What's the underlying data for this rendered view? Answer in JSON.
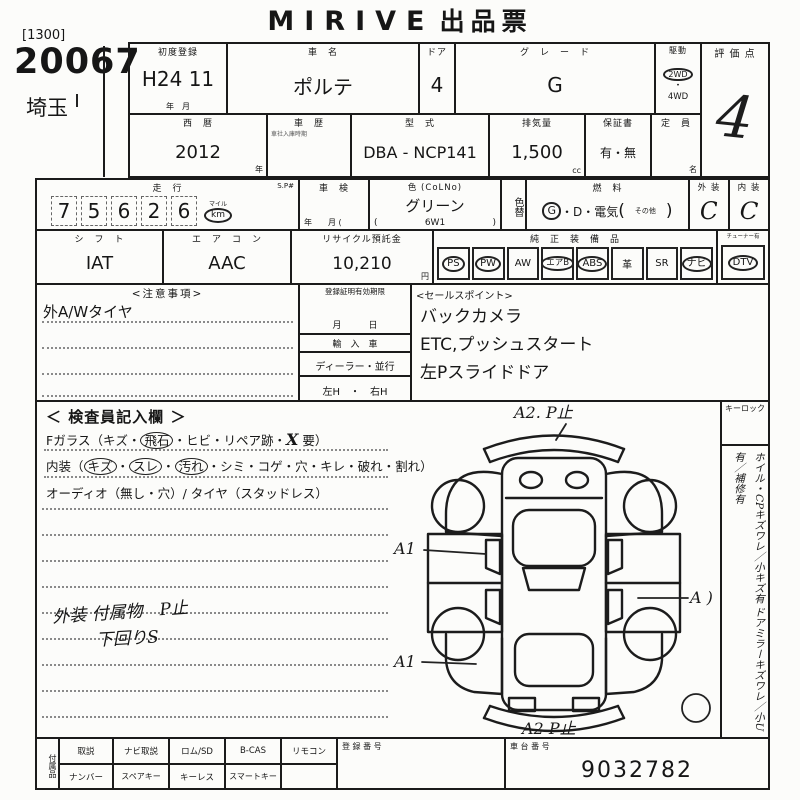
{
  "title": {
    "brand": "MIRIVE",
    "doc": "出品票"
  },
  "corner": {
    "code": "[1300]",
    "lot": "20067",
    "region": "埼玉"
  },
  "r1": {
    "first_reg_label": "初度登録",
    "first_reg": "H24 11",
    "first_reg_units": "年　月",
    "name_label": "車　名",
    "name": "ポルテ",
    "door_label": "ドア",
    "door": "4",
    "grade_label": "グ　レ　ー　ド",
    "grade": "G",
    "drive_label": "駆動",
    "drive1": "2WD",
    "drive_dot": "・",
    "drive2": "4WD",
    "score_label": "評 価 点",
    "score": "4"
  },
  "r2": {
    "year_label": "西　暦",
    "year": "2012",
    "year_unit": "年",
    "history_label": "車　歴",
    "history_note": "車社入庫時期",
    "model_label": "型　式",
    "model": "DBA - NCP141",
    "disp_label": "排気量",
    "disp": "1,500",
    "disp_unit": "cc",
    "warranty_label": "保証書",
    "warranty": "有・無",
    "cap_label": "定　員",
    "cap_unit": "名"
  },
  "r3": {
    "mileage_label": "走　行",
    "sp": "S.P#",
    "d0": "7",
    "d1": "5",
    "d2": "6",
    "d3": "2",
    "d4": "6",
    "mile": "マイル",
    "km": "km",
    "shaken_label": "車　検",
    "shaken_units": "年　　月 (",
    "color_label": "色 (CoLNo)",
    "color": "グリーン",
    "paren_l": "(",
    "color_code": "6W1",
    "paren_r": ")",
    "color_change": "色替",
    "fuel_label": "燃　料",
    "fuel_g": "G",
    "fuel_rest": "・D・電気",
    "fuel_paren_l": "(",
    "fuel_other": "その他",
    "fuel_paren_r": ")",
    "ext_label": "外 装",
    "ext": "C",
    "int_label": "内 装",
    "int": "C"
  },
  "r4": {
    "shift_label": "シ　フ　ト",
    "shift": "IAT",
    "ac_label": "エ　ア　コ　ン",
    "ac": "AAC",
    "recycle_label": "リサイクル預託金",
    "recycle": "10,210",
    "recycle_unit": "円",
    "equip_label": "純　正　装　備　品",
    "dtv_note": "チューナー有",
    "items": [
      {
        "label": "PS"
      },
      {
        "label": "PW"
      },
      {
        "label": "AW"
      },
      {
        "label": "エアB"
      },
      {
        "label": "ABS"
      },
      {
        "label": "革"
      },
      {
        "label": "SR"
      },
      {
        "label": "ナビ"
      },
      {
        "label": "DTV"
      }
    ]
  },
  "notes": {
    "title": "<注意事項>",
    "line1": "外A/Wタイヤ"
  },
  "mid": {
    "cert_label": "登録証明有効期限",
    "date_units": "月　　　日",
    "import_label": "輸　入　車",
    "dealer": "ディーラー・並行",
    "handle": "左H　・　右H"
  },
  "sales": {
    "title": "<セールスポイント>",
    "points": [
      "バックカメラ",
      "ETC,プッシュスタート",
      "左Pスライドドア"
    ]
  },
  "insp": {
    "title": "＜ 検査員記入欄 ＞",
    "fglass_label": "Fガラス",
    "fglass_p1": "（キズ・",
    "fglass_c": "飛石",
    "fglass_p2": "・ヒビ・リペア跡・",
    "fglass_x": "X",
    "fglass_p3": " 要）",
    "int_p1": "内装（",
    "int_c1": "キズ",
    "sep1": "・",
    "int_c2": "スレ",
    "sep2": "・",
    "int_c3": "汚れ",
    "int_p2": "・シミ・コゲ・穴・キレ・破れ・割れ）",
    "audio": "オーディオ（無し・穴）/ タイヤ（スタッドレス）",
    "note1": "外装 付属物　P止",
    "note2": "下回りS"
  },
  "diagram": {
    "top": "A2. P止",
    "left1": "A1",
    "right": "A )",
    "left2": "A1",
    "bottom": "A2 P止"
  },
  "side": {
    "keylock": "キーロック",
    "line1": "ホイル・CPキズワレ／小キズ有",
    "line2": "ドアミラーキズワレ／小U有／補修有"
  },
  "bottom": {
    "acc_label": "付属品",
    "r1c1": "取説",
    "r1c2": "ナビ取説",
    "r1c3": "ロム/SD",
    "r1c4": "B-CAS",
    "r1c5": "リモコン",
    "r2c1": "ナンバー",
    "r2c2": "スペアキー",
    "r2c3": "キーレス",
    "r2c4": "スマートキー",
    "r2c5": "",
    "regno_label": "登 録 番 号",
    "chassis_label": "車 台 番 号",
    "chassis_no": "9032782"
  }
}
